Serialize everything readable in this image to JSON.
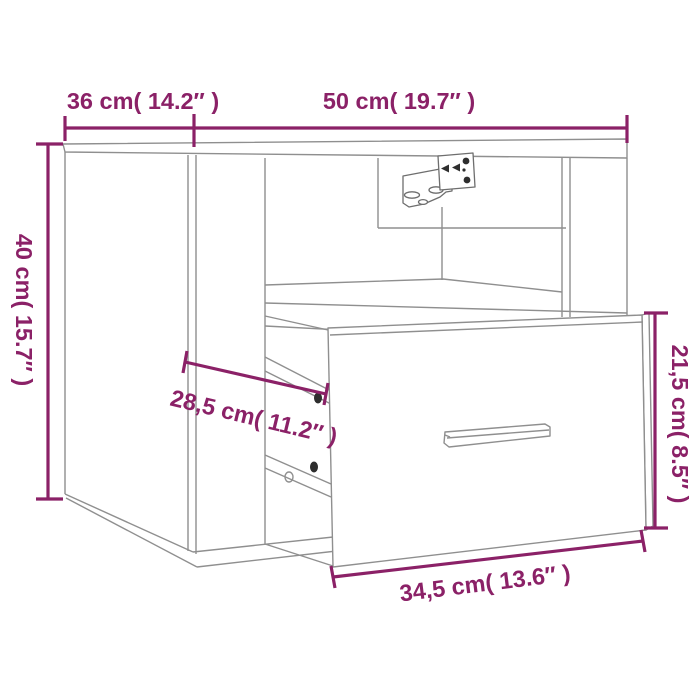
{
  "figure": {
    "kind": "product-dimension-diagram",
    "subject": "wall-mounted bedside cabinet with open drawer and wall bracket",
    "background": "#ffffff",
    "colors": {
      "dimension": "#8B2167",
      "outline": "#8f8f8f",
      "outline_dark": "#6e6e6e",
      "hardware": "#2e2e2e"
    },
    "dimensions": {
      "side_depth": {
        "label": "36 cm( 14.2″ )",
        "cm": "36",
        "inches": "14.2",
        "placement": "top-left horizontal"
      },
      "front_width": {
        "label": "50 cm( 19.7″ )",
        "cm": "50",
        "inches": "19.7",
        "placement": "top horizontal"
      },
      "height": {
        "label": "40 cm( 15.7″ )",
        "cm": "40",
        "inches": "15.7",
        "placement": "left vertical rotated"
      },
      "drawer_inner_depth": {
        "label": "28,5 cm( 11.2″ )",
        "cm": "28,5",
        "inches": "11.2",
        "placement": "middle slanted"
      },
      "drawer_front_height": {
        "label": "21,5 cm( 8.5″ )",
        "cm": "21,5",
        "inches": "8.5",
        "placement": "right vertical rotated"
      },
      "drawer_front_width": {
        "label": "34,5 cm( 13.6″ )",
        "cm": "34,5",
        "inches": "13.6",
        "placement": "bottom slanted"
      }
    }
  }
}
